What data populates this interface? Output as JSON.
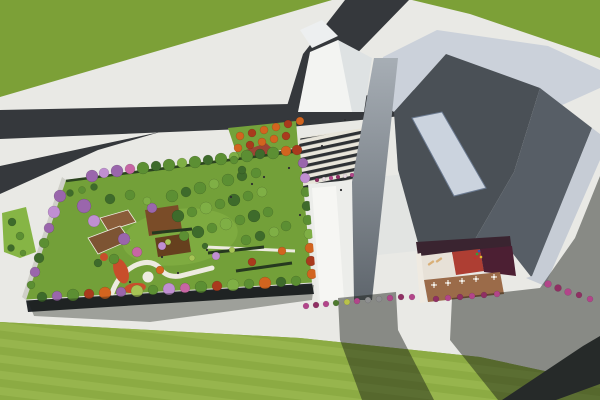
{
  "scene": {
    "description": "Aerial 3D architectural rendering: rooftop garden building with trees and winding paths at left, large angular gray museum-like building with inner courtyard terrace at right, dark asphalt roads forking through green lawns, zebra-striped plaza between the buildings",
    "palette": {
      "grass": "#7CA037",
      "grassBottom": "#8CAB43",
      "grassStripe": "#97B54D",
      "pavement": "#E9E9E5",
      "road": "#35383C",
      "lawnStrip": "#86B545",
      "plazaLawn": "#74A23B",
      "zebraDark": "#2E3134",
      "zebraLight": "#E8E5DA",
      "gardenLawn": "#73A039",
      "gardenLawnLight": "#7FAC41",
      "gardenFacade": "#23272B",
      "gardenSide": "#CFCFC8",
      "parapet": "#DFDFDA",
      "hedge": "#2C4420",
      "hedgeRow": "#26391F",
      "path": "#EDEBE0",
      "deckBrown": "#7D5433",
      "deckBrown2": "#8A5D3A",
      "pergola": "#7A4C28",
      "pergolaDark": "#66401E",
      "flowerRed": "#C84E2B",
      "structRed": "#9C4434",
      "structRedSide": "#7A3226",
      "shelter": "#3A3E42",
      "shelterRim": "#E8E8E4",
      "gableWhite": "#F3F4F2",
      "gableShade": "#DEE2E3",
      "gableSmall": "#EDEFF0",
      "whiteRoof": "#ECEDEA",
      "whiteRoofBright": "#F6F6F3",
      "lowRoof": "#E2E4E2",
      "roofBand": "#CBD1DA",
      "roofBandRight": "#C6CCD5",
      "slopeDark": "#4A5056",
      "slopeMid": "#575E66",
      "skylight": "#CBD3DE",
      "skylightEdge": "#6B7A90",
      "towerTop": "#A7AEB5",
      "towerBottom": "#5F666D",
      "courtWall": "#3A2430",
      "courtWhite": "#E7E1D7",
      "courtRed": "#AE3E33",
      "courtMaroon": "#4C1F33",
      "courtDeck": "#9B6B49",
      "courtRim": "#EFEAE1",
      "tableWhite": "#F4F1EA",
      "lounger": "#D9B078",
      "person": "#2E2E30",
      "shadow": "rgba(22,26,20,0.46)",
      "shadowSoft": "rgba(25,30,22,0.36)"
    },
    "treeColors": {
      "g1": "#3E6B2B",
      "g2": "#5C8F33",
      "g3": "#7FAF45",
      "g4": "#A6C455",
      "pu": "#9A66AC",
      "vi": "#C08FD2",
      "pk": "#C766A4",
      "or": "#D2641F",
      "ru": "#A93A1D"
    },
    "shrubColors": {
      "mg": "#B2458A",
      "pk2": "#8F2F63",
      "gn": "#4E7A2E",
      "yl": "#B9C24A",
      "gy": "#8E8F90",
      "wh": "#E8DCE2"
    },
    "trees": [
      [
        92,
        176,
        6,
        "pu"
      ],
      [
        104,
        173,
        5,
        "vi"
      ],
      [
        117,
        171,
        6,
        "pu"
      ],
      [
        130,
        169,
        5,
        "pk"
      ],
      [
        143,
        168,
        6,
        "g2"
      ],
      [
        156,
        166,
        5,
        "g1"
      ],
      [
        169,
        165,
        6,
        "g2"
      ],
      [
        182,
        163,
        5,
        "g3"
      ],
      [
        195,
        162,
        6,
        "g2"
      ],
      [
        208,
        160,
        5,
        "g1"
      ],
      [
        221,
        159,
        6,
        "g2"
      ],
      [
        234,
        157,
        5,
        "g3"
      ],
      [
        247,
        156,
        6,
        "g2"
      ],
      [
        260,
        154,
        5,
        "g1"
      ],
      [
        273,
        153,
        6,
        "g2"
      ],
      [
        286,
        151,
        5,
        "or"
      ],
      [
        297,
        150,
        5,
        "ru"
      ],
      [
        303,
        163,
        5,
        "pu"
      ],
      [
        305,
        178,
        5,
        "vi"
      ],
      [
        306,
        192,
        5,
        "g2"
      ],
      [
        307,
        206,
        5,
        "g1"
      ],
      [
        308,
        220,
        5,
        "g2"
      ],
      [
        309,
        234,
        5,
        "g3"
      ],
      [
        310,
        248,
        5,
        "or"
      ],
      [
        311,
        261,
        5,
        "ru"
      ],
      [
        312,
        274,
        5,
        "or"
      ],
      [
        296,
        281,
        5,
        "g2"
      ],
      [
        281,
        282,
        5,
        "g1"
      ],
      [
        265,
        283,
        6,
        "or"
      ],
      [
        249,
        284,
        5,
        "g2"
      ],
      [
        233,
        285,
        6,
        "g3"
      ],
      [
        217,
        286,
        5,
        "ru"
      ],
      [
        201,
        287,
        6,
        "g2"
      ],
      [
        185,
        288,
        5,
        "pk"
      ],
      [
        169,
        289,
        6,
        "vi"
      ],
      [
        153,
        290,
        5,
        "g2"
      ],
      [
        137,
        291,
        6,
        "g4"
      ],
      [
        121,
        292,
        5,
        "pu"
      ],
      [
        105,
        293,
        6,
        "or"
      ],
      [
        89,
        294,
        5,
        "ru"
      ],
      [
        73,
        295,
        6,
        "g2"
      ],
      [
        57,
        296,
        5,
        "pu"
      ],
      [
        42,
        297,
        5,
        "g1"
      ],
      [
        60,
        196,
        6,
        "pu"
      ],
      [
        54,
        212,
        6,
        "vi"
      ],
      [
        49,
        228,
        5,
        "pu"
      ],
      [
        44,
        243,
        5,
        "g2"
      ],
      [
        39,
        258,
        5,
        "g1"
      ],
      [
        35,
        272,
        5,
        "pu"
      ],
      [
        31,
        285,
        4,
        "g2"
      ],
      [
        172,
        196,
        6,
        "g2"
      ],
      [
        186,
        192,
        5,
        "g1"
      ],
      [
        200,
        188,
        6,
        "g2"
      ],
      [
        214,
        184,
        5,
        "g3"
      ],
      [
        228,
        180,
        6,
        "g2"
      ],
      [
        242,
        176,
        5,
        "g1"
      ],
      [
        256,
        173,
        5,
        "g2"
      ],
      [
        178,
        216,
        6,
        "g1"
      ],
      [
        192,
        212,
        5,
        "g2"
      ],
      [
        206,
        208,
        6,
        "g3"
      ],
      [
        220,
        204,
        5,
        "g2"
      ],
      [
        234,
        200,
        6,
        "g1"
      ],
      [
        248,
        196,
        5,
        "g2"
      ],
      [
        262,
        192,
        5,
        "g3"
      ],
      [
        184,
        236,
        5,
        "g2"
      ],
      [
        198,
        232,
        6,
        "g1"
      ],
      [
        212,
        228,
        5,
        "g2"
      ],
      [
        226,
        224,
        6,
        "g3"
      ],
      [
        240,
        220,
        5,
        "g2"
      ],
      [
        254,
        216,
        6,
        "g1"
      ],
      [
        268,
        212,
        5,
        "g2"
      ],
      [
        246,
        240,
        5,
        "g2"
      ],
      [
        260,
        236,
        5,
        "g1"
      ],
      [
        274,
        232,
        5,
        "g3"
      ],
      [
        286,
        226,
        5,
        "g2"
      ],
      [
        152,
        208,
        5,
        "pu"
      ],
      [
        162,
        246,
        4,
        "vi"
      ],
      [
        216,
        256,
        4,
        "vi"
      ],
      [
        84,
        206,
        7,
        "pu"
      ],
      [
        94,
        221,
        6,
        "vi"
      ],
      [
        124,
        239,
        6,
        "pu"
      ],
      [
        137,
        252,
        5,
        "pk"
      ],
      [
        110,
        199,
        5,
        "g1"
      ],
      [
        130,
        195,
        5,
        "g2"
      ],
      [
        147,
        201,
        4,
        "g3"
      ],
      [
        114,
        259,
        5,
        "g2"
      ],
      [
        98,
        263,
        4,
        "g1"
      ],
      [
        160,
        270,
        4,
        "or"
      ],
      [
        252,
        262,
        4,
        "ru"
      ],
      [
        282,
        251,
        4,
        "or"
      ],
      [
        168,
        242,
        3,
        "g4"
      ],
      [
        192,
        258,
        3,
        "g4"
      ],
      [
        232,
        250,
        3,
        "g4"
      ],
      [
        205,
        246,
        3,
        "g1"
      ],
      [
        240,
        136,
        4,
        "or"
      ],
      [
        252,
        133,
        4,
        "ru"
      ],
      [
        264,
        130,
        4,
        "or"
      ],
      [
        276,
        127,
        4,
        "or"
      ],
      [
        288,
        124,
        4,
        "ru"
      ],
      [
        300,
        121,
        4,
        "or"
      ],
      [
        238,
        148,
        4,
        "or"
      ],
      [
        250,
        145,
        4,
        "ru"
      ],
      [
        262,
        142,
        4,
        "or"
      ],
      [
        274,
        139,
        4,
        "or"
      ],
      [
        286,
        136,
        4,
        "ru"
      ],
      [
        234,
        160,
        4,
        "g2"
      ],
      [
        242,
        170,
        4,
        "g1"
      ],
      [
        70,
        193,
        3.5,
        "g1"
      ],
      [
        82,
        190,
        3.5,
        "g2"
      ],
      [
        94,
        187,
        3.5,
        "g1"
      ],
      [
        12,
        222,
        4,
        "g1"
      ],
      [
        20,
        236,
        4,
        "g2"
      ],
      [
        11,
        248,
        3.5,
        "g1"
      ],
      [
        23,
        253,
        3,
        "g2"
      ]
    ],
    "shrubs": [
      [
        306,
        306,
        3,
        "mg"
      ],
      [
        316,
        305,
        3,
        "pk2"
      ],
      [
        326,
        304,
        3,
        "mg"
      ],
      [
        336,
        303,
        3,
        "gn"
      ],
      [
        347,
        302,
        3,
        "yl"
      ],
      [
        357,
        301,
        3,
        "mg"
      ],
      [
        368,
        300,
        3,
        "gy"
      ],
      [
        379,
        299,
        3,
        "gy"
      ],
      [
        390,
        298,
        3,
        "mg"
      ],
      [
        401,
        297,
        3,
        "pk2"
      ],
      [
        412,
        297,
        3,
        "mg"
      ],
      [
        436,
        299,
        3,
        "pk2"
      ],
      [
        448,
        298,
        3,
        "mg"
      ],
      [
        460,
        297,
        3,
        "pk2"
      ],
      [
        472,
        296,
        3,
        "mg"
      ],
      [
        484,
        295,
        3,
        "pk2"
      ],
      [
        497,
        294,
        3,
        "mg"
      ],
      [
        548,
        284,
        3.5,
        "mg"
      ],
      [
        558,
        288,
        3.5,
        "pk2"
      ],
      [
        568,
        292,
        3.5,
        "mg"
      ],
      [
        579,
        295,
        3,
        "pk2"
      ],
      [
        590,
        299,
        3,
        "mg"
      ],
      [
        317,
        180,
        2,
        "pk2"
      ],
      [
        324,
        179,
        2,
        "wh"
      ],
      [
        331,
        178,
        2,
        "mg"
      ],
      [
        338,
        177,
        2,
        "pk2"
      ],
      [
        345,
        176,
        2,
        "wh"
      ],
      [
        352,
        175,
        2,
        "mg"
      ]
    ],
    "tables": [
      [
        434,
        285
      ],
      [
        448,
        283
      ],
      [
        462,
        281
      ],
      [
        476,
        279
      ],
      [
        494,
        277
      ]
    ],
    "loungers": [
      [
        431,
        263,
        -35
      ],
      [
        439,
        260,
        -35
      ]
    ],
    "playground": [
      [
        477,
        254,
        "#2FA03C"
      ],
      [
        481,
        257,
        "#E0B82F"
      ],
      [
        475,
        258,
        "#C23030"
      ],
      [
        479,
        251,
        "#3553C0"
      ]
    ],
    "people": [
      [
        252,
        184
      ],
      [
        264,
        177
      ],
      [
        289,
        168
      ],
      [
        322,
        146
      ],
      [
        341,
        190
      ],
      [
        231,
        197
      ],
      [
        162,
        257
      ],
      [
        207,
        250
      ],
      [
        300,
        215
      ],
      [
        345,
        120
      ],
      [
        130,
        282
      ],
      [
        178,
        273
      ]
    ]
  }
}
